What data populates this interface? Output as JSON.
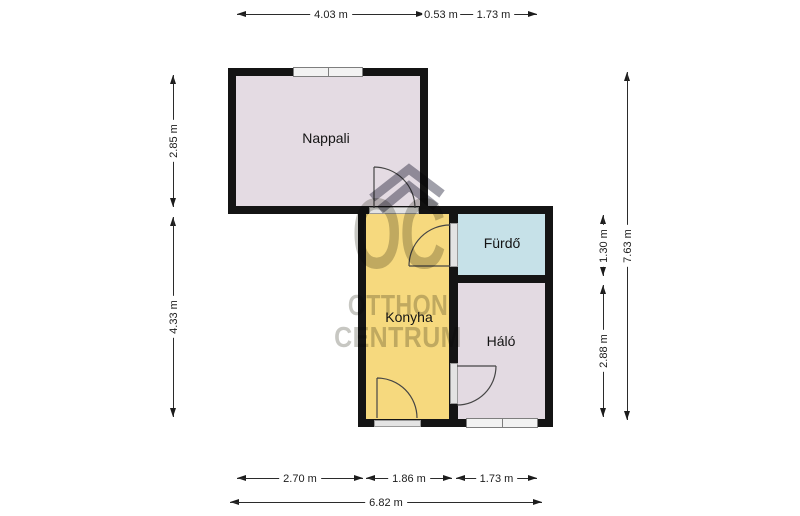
{
  "plan": {
    "rooms": [
      {
        "id": "nappali",
        "label": "Nappali",
        "color": "#e4dbe3"
      },
      {
        "id": "konyha",
        "label": "Konyha",
        "color": "#f6d97e"
      },
      {
        "id": "furdo",
        "label": "Fürdő",
        "color": "#c6e1e8"
      },
      {
        "id": "halo",
        "label": "Háló",
        "color": "#e3dae2"
      }
    ]
  },
  "dimensions": {
    "top": [
      "4.03 m",
      "0.53 m",
      "1.73 m"
    ],
    "left": [
      "2.85 m",
      "4.33 m"
    ],
    "right": [
      "1.30 m",
      "2.88 m"
    ],
    "right_total": "7.63 m",
    "bottom": [
      "2.70 m",
      "1.86 m",
      "1.73 m"
    ],
    "bottom_total": "6.82 m"
  },
  "watermark": {
    "monogram": "OC",
    "line1": "OTTHON",
    "line2": "CENTRUM"
  },
  "colors": {
    "wall": "#141414",
    "window_fill": "#f2f2f2",
    "door_threshold": "#e3e3e3",
    "watermark_text": "#c7c7c2",
    "watermark_roof": "#a0a0aa"
  }
}
